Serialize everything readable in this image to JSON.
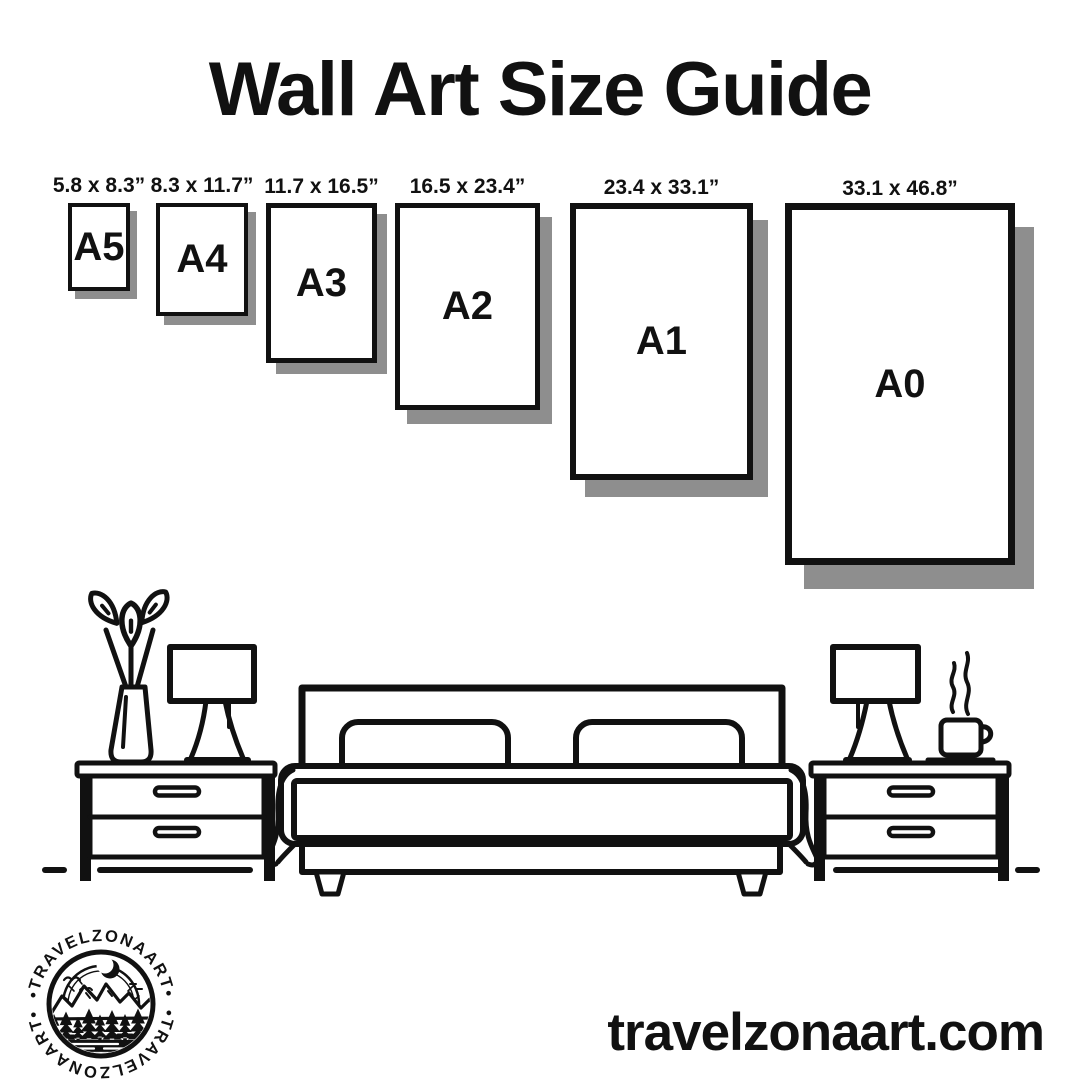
{
  "title": "Wall Art Size Guide",
  "sizes": [
    {
      "name": "A5",
      "dimensions": "5.8 x 8.3”"
    },
    {
      "name": "A4",
      "dimensions": "8.3 x 11.7”"
    },
    {
      "name": "A3",
      "dimensions": "11.7 x 16.5”"
    },
    {
      "name": "A2",
      "dimensions": "16.5 x 23.4”"
    },
    {
      "name": "A1",
      "dimensions": "23.4 x 33.1”"
    },
    {
      "name": "A0",
      "dimensions": "33.1 x 46.8”"
    }
  ],
  "brand": {
    "website": "travelzonaart.com",
    "logo_text_top": "•TRAVELZONAART•",
    "logo_text_bottom": "•TRAVELZONAART•"
  },
  "colors": {
    "ink": "#111111",
    "paper": "#ffffff",
    "shadow": "#8e8e8e"
  },
  "illustration": {
    "items": [
      "vase-with-flowers",
      "table-lamp-left",
      "double-bed",
      "table-lamp-right",
      "coffee-cup",
      "nightstand-left",
      "nightstand-right",
      "floor-line"
    ],
    "logo_icon": "mountain-forest-moon-badge"
  }
}
